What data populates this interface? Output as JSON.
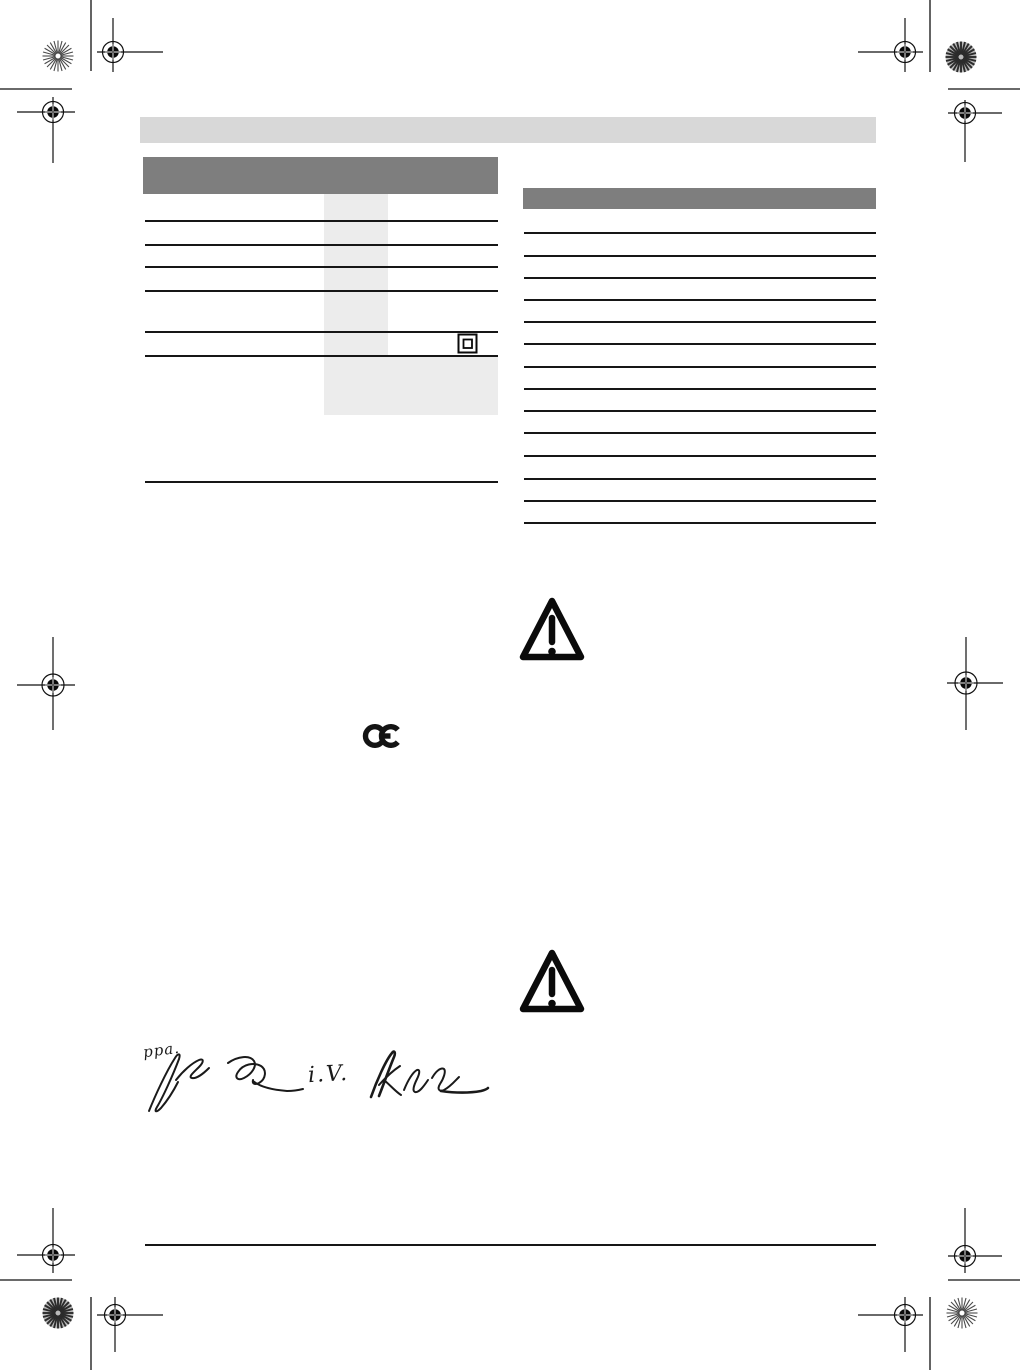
{
  "document": {
    "kind": "scanned-manual-page",
    "note": "graphics layer only; no printed body text visible"
  },
  "colors": {
    "page_background": "#ffffff",
    "banner_gray": "#d8d8d8",
    "table_header_gray": "#7e7e7e",
    "table_shade_gray": "#ececec",
    "rule_black": "#161616"
  },
  "left_table": {
    "rule_count": 6,
    "has_bottom_rule": true
  },
  "right_table": {
    "rule_count": 14
  },
  "signatures": {
    "left_prefix": "ppa.",
    "right_prefix": "i.V."
  },
  "icons": {
    "warning_triangle": "triangle with exclamation mark",
    "ce_mark": "CE",
    "double_insulation": "square within square",
    "registration_crosshair": "circled crosshair target",
    "calibration_star": "radial sunburst star"
  }
}
